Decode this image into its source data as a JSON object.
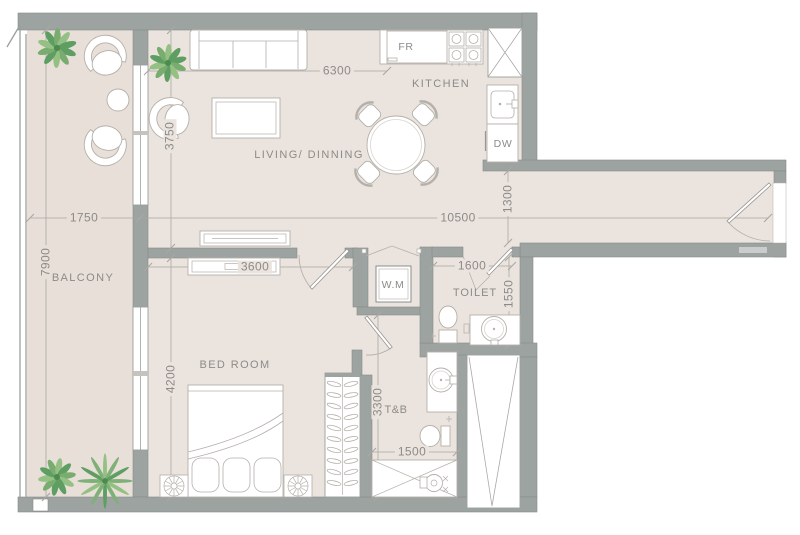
{
  "plan": {
    "rooms": {
      "balcony": "BALCONY",
      "living_dining": "LIVING/ DINNING",
      "kitchen": "KITCHEN",
      "bedroom": "BED ROOM",
      "toilet": "TOILET",
      "bath": "T&B"
    },
    "appliances": {
      "fridge": "FR",
      "dishwasher": "DW",
      "washer": "W.M"
    },
    "dimensions_mm": {
      "balcony_width": "1750",
      "balcony_length": "7900",
      "living_width": "6300",
      "living_depth": "3750",
      "overall_length": "10500",
      "corridor_width": "1300",
      "bedroom_width": "3600",
      "bedroom_depth": "4200",
      "toilet_width": "1600",
      "toilet_depth": "1550",
      "bath_depth": "3300",
      "bath_width": "1500"
    },
    "colors": {
      "wall": "#9DA3A1",
      "floor": "#EBE3DD",
      "balcony_floor": "#E7DFD8",
      "furniture_line": "#B5B0AA",
      "dimension_line": "#ABA8A3",
      "text": "#8C8B88",
      "plant_dark": "#5F9E63",
      "plant_light": "#94C183"
    }
  }
}
